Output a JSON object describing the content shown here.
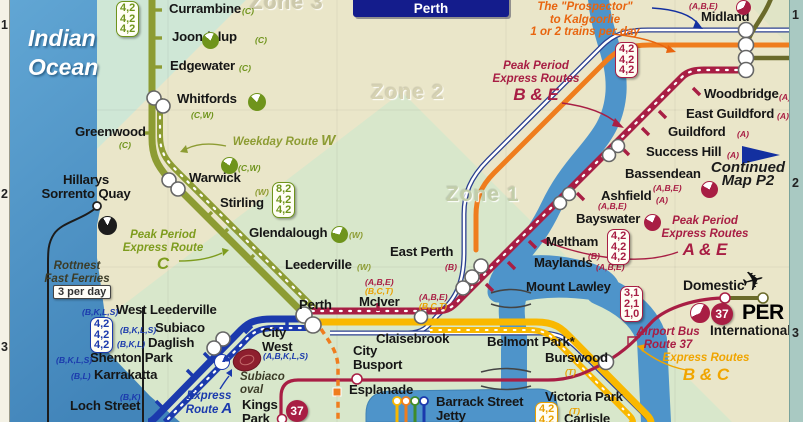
{
  "title": {
    "map_title": "Perth"
  },
  "ocean": {
    "line1": "Indian",
    "line2": "Ocean"
  },
  "zones": {
    "zone1": "Zone 1",
    "zone2": "Zone 2",
    "zone3": "Zone 3"
  },
  "grid": {
    "left": [
      "1",
      "2",
      "3"
    ],
    "right": [
      "1",
      "2",
      "3"
    ]
  },
  "airport": {
    "domestic": "Domestic",
    "code": "PER",
    "international": "International"
  },
  "ferry": {
    "per_day": "3 per day"
  },
  "badges": {
    "route37": "37"
  },
  "plane_icon": "airplane",
  "colors": {
    "beige": "#eae6c9",
    "zone1_green": "#d8e7cb",
    "mint": "#cfe7d6",
    "corner": "#e0e4c6",
    "ocean": "#4f96c8",
    "river": "#4e94ca",
    "joondalup_line": "#8d9c33",
    "fremantle_line": "#1b3aad",
    "midland_line": "#a81e44",
    "armadale_line": "#f9b800",
    "country_line": "#2a3f8f",
    "avonlink_line": "#ef7d1e",
    "shuttle_line": "#6a6a2a",
    "ferry_line": "#1c1c1c",
    "tag_green": "#6f941c",
    "tag_olive": "#8d9c33",
    "tag_crimson": "#a81e44",
    "tag_blue": "#1b3aad",
    "tag_orange": "#e9a000",
    "title_bg": "#141c8c",
    "arrow_blue": "#1330a0"
  },
  "stations": [
    {
      "lines": [
        "Currambine"
      ],
      "x": 169,
      "y": 2
    },
    {
      "lines": [
        "Joondalup"
      ],
      "x": 172,
      "y": 30
    },
    {
      "lines": [
        "Edgewater"
      ],
      "x": 170,
      "y": 59
    },
    {
      "lines": [
        "Whitfords"
      ],
      "x": 177,
      "y": 92
    },
    {
      "lines": [
        "Greenwood"
      ],
      "x": 75,
      "y": 125
    },
    {
      "lines": [
        "Warwick"
      ],
      "x": 189,
      "y": 171
    },
    {
      "lines": [
        "Stirling"
      ],
      "x": 220,
      "y": 196
    },
    {
      "lines": [
        "Glendalough"
      ],
      "x": 249,
      "y": 226
    },
    {
      "lines": [
        "Leederville"
      ],
      "x": 285,
      "y": 258
    },
    {
      "lines": [
        "Perth"
      ],
      "x": 299,
      "y": 298
    },
    {
      "lines": [
        "McIver"
      ],
      "x": 359,
      "y": 295
    },
    {
      "lines": [
        "East Perth"
      ],
      "x": 390,
      "y": 245
    },
    {
      "lines": [
        "Claisebrook"
      ],
      "x": 376,
      "y": 332
    },
    {
      "lines": [
        "City",
        "West"
      ],
      "x": 262,
      "y": 326
    },
    {
      "lines": [
        "West Leederville"
      ],
      "x": 116,
      "y": 303
    },
    {
      "lines": [
        "Subiaco"
      ],
      "x": 155,
      "y": 321
    },
    {
      "lines": [
        "Daglish"
      ],
      "x": 148,
      "y": 336
    },
    {
      "lines": [
        "Shenton Park"
      ],
      "x": 90,
      "y": 351
    },
    {
      "lines": [
        "Karrakatta"
      ],
      "x": 94,
      "y": 368
    },
    {
      "lines": [
        "Loch Street"
      ],
      "x": 70,
      "y": 399
    },
    {
      "lines": [
        "City",
        "Busport"
      ],
      "x": 353,
      "y": 344
    },
    {
      "lines": [
        "Esplanade"
      ],
      "x": 349,
      "y": 383
    },
    {
      "lines": [
        "Barrack Street",
        "Jetty"
      ],
      "x": 436,
      "y": 395
    },
    {
      "lines": [
        "Kings",
        "Park"
      ],
      "x": 242,
      "y": 398
    },
    {
      "lines": [
        "Belmont Park*"
      ],
      "x": 487,
      "y": 335
    },
    {
      "lines": [
        "Burswood"
      ],
      "x": 545,
      "y": 351
    },
    {
      "lines": [
        "Victoria Park"
      ],
      "x": 545,
      "y": 390
    },
    {
      "lines": [
        "Carlisle"
      ],
      "x": 564,
      "y": 412
    },
    {
      "lines": [
        "Mount Lawley"
      ],
      "x": 526,
      "y": 280
    },
    {
      "lines": [
        "Maylands"
      ],
      "x": 534,
      "y": 256
    },
    {
      "lines": [
        "Meltham"
      ],
      "x": 546,
      "y": 235
    },
    {
      "lines": [
        "Bayswater"
      ],
      "x": 576,
      "y": 212
    },
    {
      "lines": [
        "Ashfield"
      ],
      "x": 601,
      "y": 189
    },
    {
      "lines": [
        "Bassendean"
      ],
      "x": 625,
      "y": 167
    },
    {
      "lines": [
        "Success Hill"
      ],
      "x": 646,
      "y": 145
    },
    {
      "lines": [
        "Guildford"
      ],
      "x": 668,
      "y": 125
    },
    {
      "lines": [
        "East Guildford"
      ],
      "x": 686,
      "y": 107
    },
    {
      "lines": [
        "Woodbridge"
      ],
      "x": 704,
      "y": 87
    },
    {
      "lines": [
        "Midland"
      ],
      "x": 701,
      "y": 10
    },
    {
      "lines": [
        "Hillarys",
        "Sorrento Quay"
      ],
      "x": 40,
      "y": 173,
      "align": "center",
      "w": 92
    }
  ],
  "route_tags": [
    {
      "t": "(C)",
      "x": 242,
      "y": 6,
      "c": "tag_green"
    },
    {
      "t": "(C)",
      "x": 255,
      "y": 35,
      "c": "tag_green"
    },
    {
      "t": "(C)",
      "x": 239,
      "y": 63,
      "c": "tag_green"
    },
    {
      "t": "(C,W)",
      "x": 191,
      "y": 110,
      "c": "tag_green"
    },
    {
      "t": "(C)",
      "x": 119,
      "y": 140,
      "c": "tag_green"
    },
    {
      "t": "(C,W)",
      "x": 238,
      "y": 163,
      "c": "tag_green"
    },
    {
      "t": "(W)",
      "x": 255,
      "y": 187,
      "c": "tag_olive"
    },
    {
      "t": "(W)",
      "x": 349,
      "y": 230,
      "c": "tag_olive"
    },
    {
      "t": "(W)",
      "x": 357,
      "y": 262,
      "c": "tag_olive"
    },
    {
      "t": "(B)",
      "x": 445,
      "y": 262,
      "c": "tag_crimson"
    },
    {
      "t": "(A,B,E)",
      "x": 365,
      "y": 277,
      "c": "tag_crimson"
    },
    {
      "t": "(B,C,T)",
      "x": 365,
      "y": 286,
      "c": "tag_orange"
    },
    {
      "t": "(A,B,E)",
      "x": 419,
      "y": 292,
      "c": "tag_crimson"
    },
    {
      "t": "(B,C,T)",
      "x": 419,
      "y": 301,
      "c": "tag_orange"
    },
    {
      "t": "(B,K,L,S)",
      "x": 82,
      "y": 307,
      "c": "tag_blue"
    },
    {
      "t": "(B,K,L,S)",
      "x": 120,
      "y": 325,
      "c": "tag_blue"
    },
    {
      "t": "(B,K,L)",
      "x": 117,
      "y": 339,
      "c": "tag_blue"
    },
    {
      "t": "(B,K,L,S)",
      "x": 56,
      "y": 355,
      "c": "tag_blue"
    },
    {
      "t": "(B,L)",
      "x": 71,
      "y": 371,
      "c": "tag_blue"
    },
    {
      "t": "(B,K)",
      "x": 120,
      "y": 392,
      "c": "tag_blue"
    },
    {
      "t": "(A,B,K,L,S)",
      "x": 263,
      "y": 351,
      "c": "tag_blue"
    },
    {
      "t": "(B)",
      "x": 628,
      "y": 284,
      "c": "tag_crimson"
    },
    {
      "t": "(A,B,E)",
      "x": 596,
      "y": 262,
      "c": "tag_crimson"
    },
    {
      "t": "(B)",
      "x": 588,
      "y": 251,
      "c": "tag_crimson"
    },
    {
      "t": "(A,B,E)",
      "x": 598,
      "y": 201,
      "c": "tag_crimson"
    },
    {
      "t": "(A)",
      "x": 656,
      "y": 195,
      "c": "tag_crimson"
    },
    {
      "t": "(A,B,E)",
      "x": 653,
      "y": 183,
      "c": "tag_crimson"
    },
    {
      "t": "(A)",
      "x": 727,
      "y": 150,
      "c": "tag_crimson"
    },
    {
      "t": "(A)",
      "x": 737,
      "y": 129,
      "c": "tag_crimson"
    },
    {
      "t": "(A)",
      "x": 777,
      "y": 111,
      "c": "tag_crimson"
    },
    {
      "t": "(A)",
      "x": 779,
      "y": 92,
      "c": "tag_crimson"
    },
    {
      "t": "(A,B,E)",
      "x": 689,
      "y": 1,
      "c": "tag_crimson"
    },
    {
      "t": "(T)",
      "x": 565,
      "y": 367,
      "c": "tag_orange"
    },
    {
      "t": "(T)",
      "x": 569,
      "y": 406,
      "c": "tag_orange"
    }
  ],
  "pies": [
    {
      "x": 202,
      "y": 32,
      "s": 15,
      "c": "tag_green",
      "deg": 285
    },
    {
      "x": 248,
      "y": 93,
      "s": 16,
      "c": "tag_green",
      "deg": 290
    },
    {
      "x": 221,
      "y": 157,
      "s": 15,
      "c": "tag_green",
      "deg": 280
    },
    {
      "x": 331,
      "y": 226,
      "s": 15,
      "c": "tag_green",
      "deg": 260
    },
    {
      "x": 98,
      "y": 216,
      "s": 17,
      "c": "ferry_line",
      "deg": 305
    },
    {
      "x": 214,
      "y": 354,
      "s": 14,
      "c": "tag_blue",
      "deg": 60
    },
    {
      "x": 644,
      "y": 214,
      "s": 15,
      "c": "tag_crimson",
      "deg": 275
    },
    {
      "x": 701,
      "y": 181,
      "s": 15,
      "c": "tag_crimson",
      "deg": 275
    },
    {
      "x": 736,
      "y": 0,
      "s": 13,
      "c": "tag_crimson",
      "deg": 220
    },
    {
      "x": 690,
      "y": 303,
      "s": 18,
      "c": "tag_crimson",
      "deg": 220
    }
  ],
  "freq_boxes": [
    {
      "x": 116,
      "y": 1,
      "vals": [
        "4,2",
        "4,2",
        "4,2"
      ],
      "c": "tag_green"
    },
    {
      "x": 272,
      "y": 182,
      "vals": [
        "8,2",
        "4,2",
        "4,2"
      ],
      "c": "tag_green"
    },
    {
      "x": 615,
      "y": 42,
      "vals": [
        "4,2",
        "4,2",
        "4,2"
      ],
      "c": "tag_crimson"
    },
    {
      "x": 607,
      "y": 229,
      "vals": [
        "4,2",
        "4,2",
        "4,2"
      ],
      "c": "tag_crimson"
    },
    {
      "x": 90,
      "y": 317,
      "vals": [
        "4,2",
        "4,2",
        "4,2"
      ],
      "c": "tag_blue"
    },
    {
      "x": 620,
      "y": 286,
      "vals": [
        "3,1",
        "2,1",
        "1,0"
      ],
      "c": "tag_crimson"
    },
    {
      "x": 535,
      "y": 402,
      "vals": [
        "4,2",
        "4,2"
      ],
      "c": "tag_orange"
    }
  ],
  "annotations": [
    {
      "x": 585,
      "y": 1,
      "c": "#e8650f",
      "lines": [
        {
          "t": "The \"Prospector\""
        },
        {
          "t": "to Kalgoorlie"
        },
        {
          "t": "1 or 2 trains per day"
        }
      ]
    },
    {
      "x": 536,
      "y": 60,
      "c": "#a81e44",
      "lines": [
        {
          "t": "Peak Period"
        },
        {
          "t": "Express Routes"
        },
        {
          "t": "B & E",
          "big": true
        }
      ]
    },
    {
      "x": 705,
      "y": 215,
      "c": "#a81e44",
      "lines": [
        {
          "t": "Peak Period"
        },
        {
          "t": "Express Routes"
        },
        {
          "t": "A & E",
          "big": true
        }
      ]
    },
    {
      "x": 163,
      "y": 229,
      "c": "#7e9c1e",
      "lines": [
        {
          "t": "Peak Period"
        },
        {
          "t": "Express Route"
        },
        {
          "t": "C",
          "big": true
        }
      ]
    },
    {
      "x": 284,
      "y": 135,
      "c": "#8d9c33",
      "lines": [
        {
          "t": "Weekday Route",
          "tail": "W"
        }
      ]
    },
    {
      "x": 209,
      "y": 390,
      "c": "#1b3aad",
      "lines": [
        {
          "t": "Express"
        },
        {
          "t": "Route",
          "tail": "A"
        }
      ]
    },
    {
      "x": 706,
      "y": 352,
      "c": "#f0a500",
      "lines": [
        {
          "t": "Express Routes"
        },
        {
          "t": "B & C",
          "big": true
        }
      ]
    },
    {
      "x": 668,
      "y": 326,
      "c": "#a81e44",
      "lines": [
        {
          "t": "Airport Bus"
        },
        {
          "t": "Route 37"
        }
      ]
    },
    {
      "x": 77,
      "y": 260,
      "c": "#3c3c28",
      "lines": [
        {
          "t": "Rottnest"
        },
        {
          "t": "Fast Ferries"
        }
      ]
    },
    {
      "x": 748,
      "y": 162,
      "c": "#1c1c1c",
      "size": 15,
      "lines": [
        {
          "t": "Continued"
        },
        {
          "t": "Map P2"
        }
      ]
    },
    {
      "x": 240,
      "y": 371,
      "c": "#3c3c28",
      "align": "left",
      "lines": [
        {
          "t": "Subiaco"
        },
        {
          "t": "oval"
        }
      ]
    }
  ]
}
